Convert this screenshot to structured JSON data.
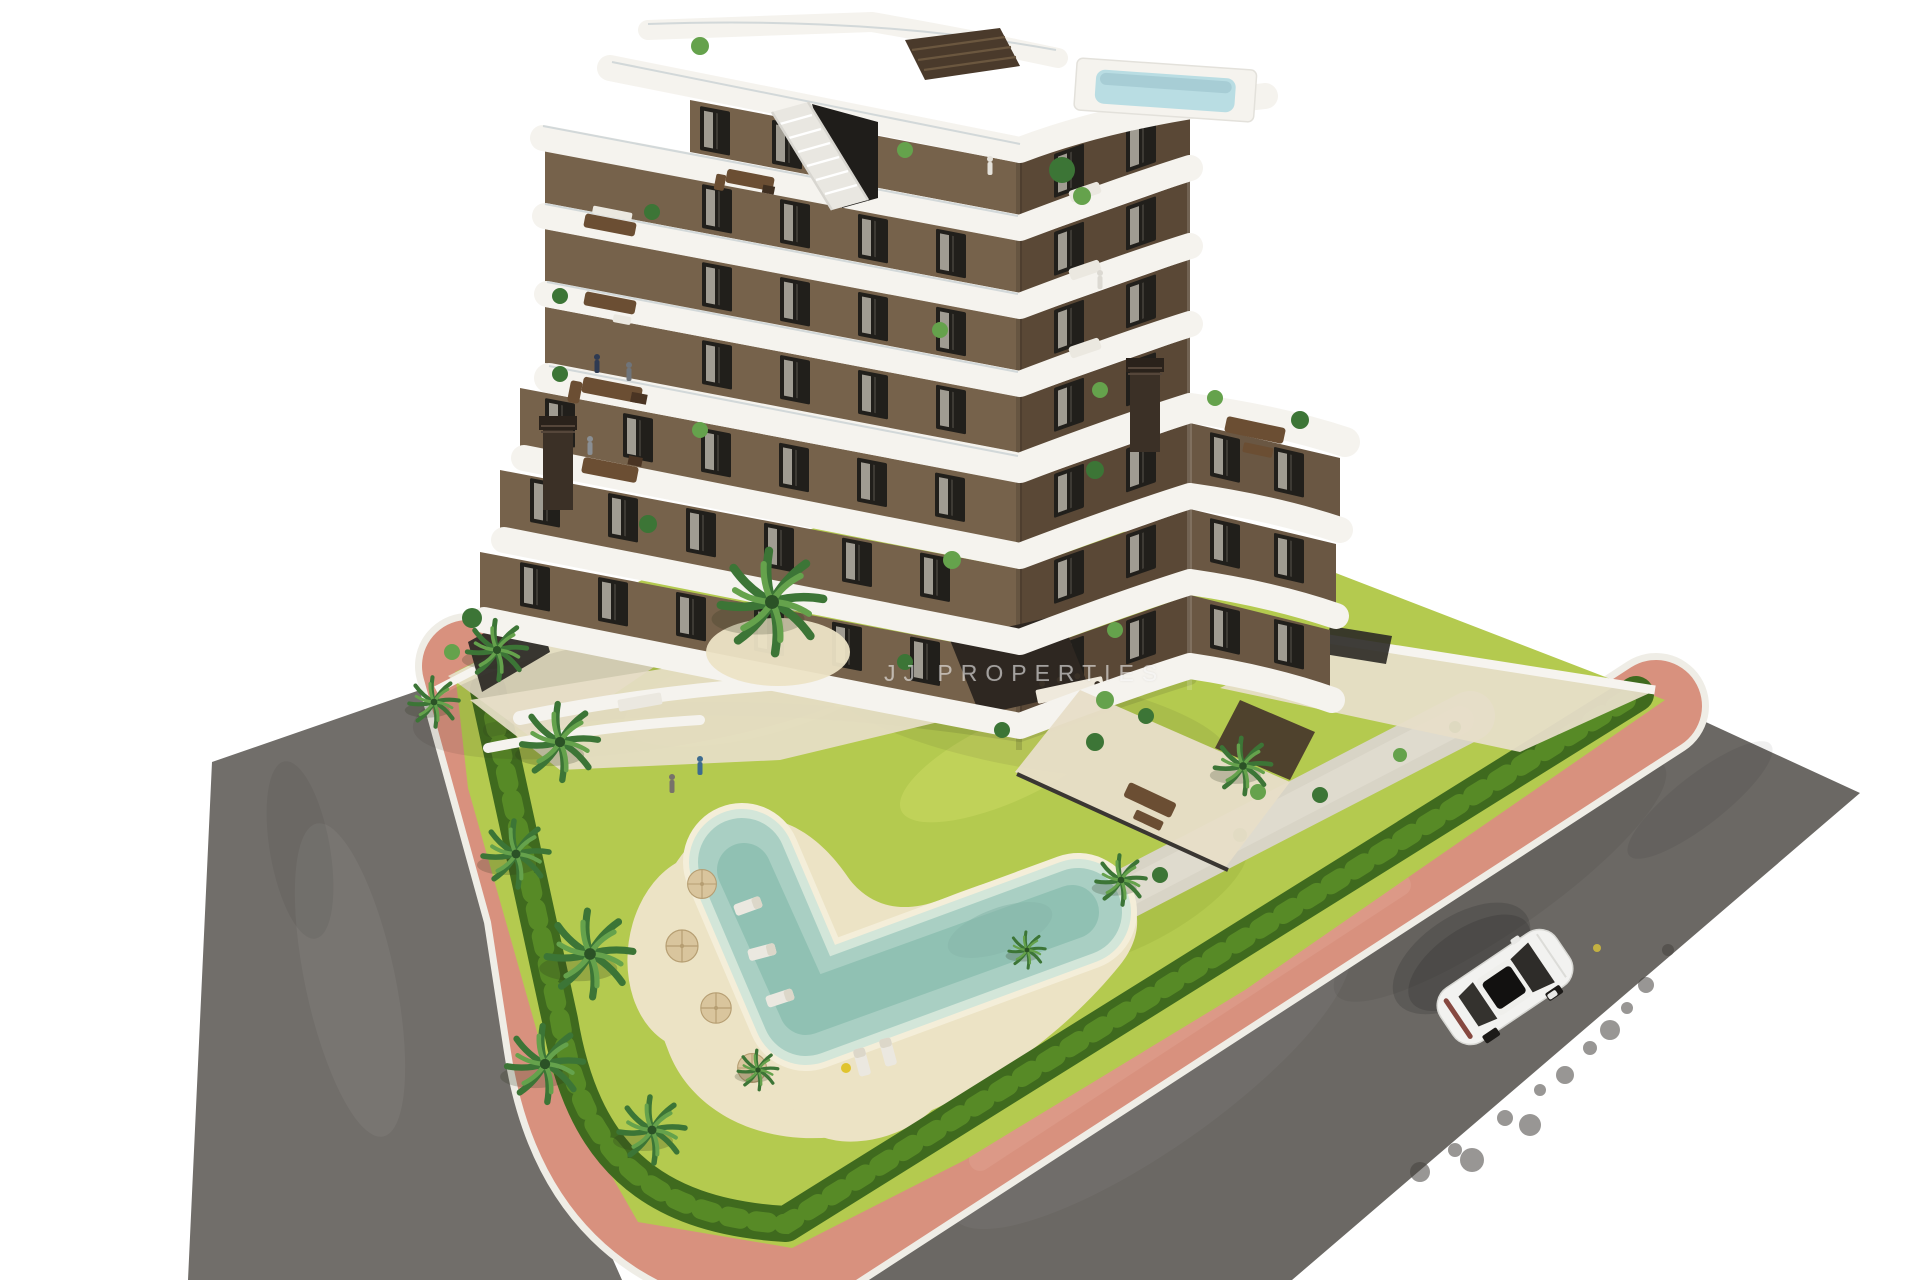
{
  "watermark": {
    "text": "JJ PROPERTIES"
  },
  "scene": {
    "description": "Aerial 3D architectural render: modern 7-storey apartment building with curved white balcony bands and brown facades, rooftop plunge pool, landscaped garden with boomerang-shaped pool, palm trees, hedges, pink promenade paths, asphalt streets and one white car",
    "elements": [
      "apartment-building",
      "rooftop-terrace",
      "rooftop-plunge-pool",
      "balconies",
      "garden",
      "lawn",
      "swimming-pool",
      "pool-deck",
      "sun-umbrellas",
      "sun-loungers",
      "palm-trees",
      "hedges",
      "gravel-path",
      "pink-promenade",
      "asphalt-street-left",
      "asphalt-street-right",
      "white-car",
      "entrance-pavement",
      "perimeter-wall",
      "watermark"
    ]
  },
  "colors": {
    "bg": "#ffffff",
    "road": "#6b6864",
    "road_left": "#716e6a",
    "curb": "#efede6",
    "path_pink": "#d8917e",
    "pink_light": "#e5ad9b",
    "lawn": "#b4ca4f",
    "lawn_light": "#cfdc66",
    "lawn_dark": "#9ab33c",
    "hedge": "#3f6a1e",
    "hedge_light": "#5c8f28",
    "gravel": "#d8d4c6",
    "deck_sand": "#ece3c5",
    "deck_rim": "#f4eed9",
    "pool_shallow": "#d3e6d9",
    "pool_mid": "#a9cfc3",
    "pool_deep": "#90c1b3",
    "palm_dark": "#3c7536",
    "palm_light": "#65a24c",
    "palm_core": "#2b5226",
    "umbrella": "#d9c59d",
    "umbrella_dark": "#b69e72",
    "facade_left": "#76624b",
    "facade_right": "#5a4836",
    "facade_wing": "#6a5743",
    "facade_recess": "#2e2721",
    "band": "#f5f3ee",
    "window": "#211f1b",
    "curtain": "#d7d1c4",
    "chimney": "#3b3026",
    "stair": "#e9e7e1",
    "glass_dark": "#1f1d1a",
    "roof_slat": "#4a3a2b",
    "roof_pool": "#b9dde3",
    "pavement": "#e7dec8",
    "wall_white": "#f6f4ef",
    "fence_dark": "#2b2925",
    "furn_brown": "#6b4e33",
    "furn_light": "#ebe8e0",
    "car_body": "#f2f2f0",
    "car_glass": "#2e2c29",
    "car_sunroof": "#121110",
    "car_tail": "#7a352c",
    "towel_yellow": "#e0c42e",
    "manhole": "#cdb93e",
    "tiremark": "#45423e",
    "watermark": "rgba(255,255,255,0.55)"
  }
}
